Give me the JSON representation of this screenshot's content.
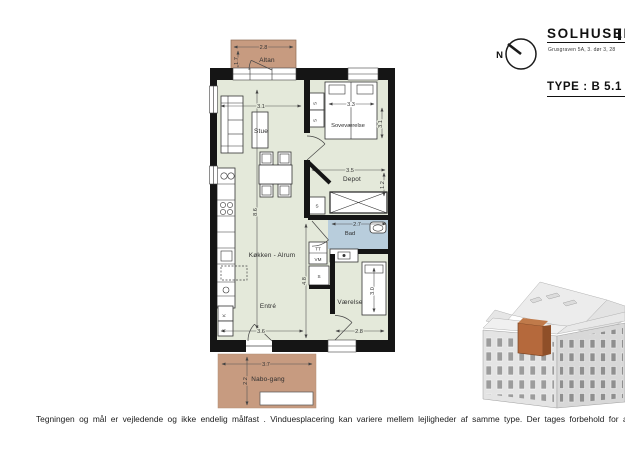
{
  "header": {
    "project_title": "SOLHUSENE",
    "address": "Grusgraven  5A,  3. dør 3,  28",
    "type_label": "TYPE : B 5.1",
    "compass": "N"
  },
  "plan": {
    "rooms": {
      "altan": "Altan",
      "stue": "Stue",
      "sovevaerelse": "Soveværelse",
      "depot": "Depot",
      "bad": "Bad",
      "koekken_alrum": "Køkken  -  Alrum",
      "entre": "Entré",
      "vaerelse": "Værelse",
      "nabo_gang": "Nabo-gang"
    },
    "closets": {
      "s": "S",
      "tt": "TT",
      "vm": "VM",
      "k": "K"
    },
    "dims": {
      "altan_w": "2.8",
      "altan_d": "1.7",
      "stue_w": "3.1",
      "sove_w": "3.3",
      "sove_h": "3.1",
      "depot_w": "3.5",
      "depot_h": "1.2",
      "bad_w": "2.7",
      "alrum_h": "8.6",
      "hall_h": "4.8",
      "entre_w": "3.6",
      "vaerelse_w": "2.8",
      "vaerelse_bed_h": "3.0",
      "nabo_w": "3.7",
      "nabo_d": "2.2"
    },
    "colors": {
      "floor": "#e4e9da",
      "balcony": "#c79b80",
      "bath": "#b8cddc",
      "wall": "#151515",
      "highlight_unit": "#b5693c"
    }
  },
  "footer": {
    "disclaimer": "Tegningen og mål er vejledende og ikke endelig målfast . Vinduesplacering  kan variere mellem lejligheder af samme type. Der tages forbehold for ændringer"
  }
}
